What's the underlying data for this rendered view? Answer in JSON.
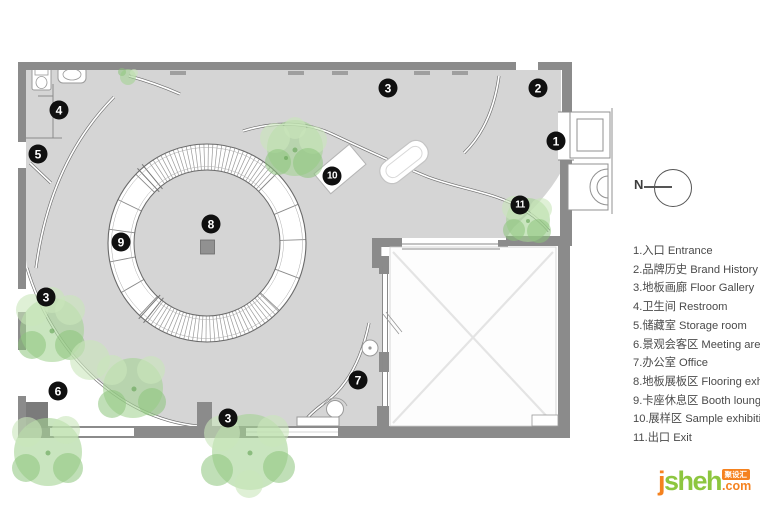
{
  "plan": {
    "markers": [
      {
        "n": "1",
        "x": 556,
        "y": 141
      },
      {
        "n": "2",
        "x": 538,
        "y": 88
      },
      {
        "n": "3",
        "x": 388,
        "y": 88
      },
      {
        "n": "3",
        "x": 46,
        "y": 297
      },
      {
        "n": "3",
        "x": 228,
        "y": 418
      },
      {
        "n": "4",
        "x": 59,
        "y": 110
      },
      {
        "n": "5",
        "x": 38,
        "y": 154
      },
      {
        "n": "6",
        "x": 58,
        "y": 391
      },
      {
        "n": "7",
        "x": 358,
        "y": 380
      },
      {
        "n": "8",
        "x": 211,
        "y": 224
      },
      {
        "n": "9",
        "x": 121,
        "y": 242
      },
      {
        "n": "10",
        "x": 332,
        "y": 176
      },
      {
        "n": "11",
        "x": 520,
        "y": 205
      }
    ],
    "colors": {
      "wall": "#8b8b8b",
      "floor": "#d5d5d5",
      "marker_bg": "#101010",
      "marker_text": "#ffffff",
      "tree_light": "#c9e6bb",
      "tree_mid": "#a5d394",
      "tree_dark": "#8cc47c"
    }
  },
  "compass": {
    "label": "N"
  },
  "legend": {
    "items": [
      {
        "num": "1",
        "zh": "入口",
        "en": "Entrance"
      },
      {
        "num": "2",
        "zh": "品牌历史",
        "en": "Brand History"
      },
      {
        "num": "3",
        "zh": "地板画廊",
        "en": "Floor Gallery"
      },
      {
        "num": "4",
        "zh": "卫生间",
        "en": "Restroom"
      },
      {
        "num": "5",
        "zh": "储藏室",
        "en": "Storage room"
      },
      {
        "num": "6",
        "zh": "景观会客区",
        "en": "Meeting area"
      },
      {
        "num": "7",
        "zh": "办公室",
        "en": "Office"
      },
      {
        "num": "8",
        "zh": "地板展板区",
        "en": "Flooring exhibition"
      },
      {
        "num": "9",
        "zh": "卡座休息区",
        "en": "Booth lounge"
      },
      {
        "num": "10",
        "zh": "展样区",
        "en": "Sample exhibition"
      },
      {
        "num": "11",
        "zh": "出口",
        "en": "Exit"
      }
    ]
  },
  "watermark": {
    "first_letter": "j",
    "rest": "sheh",
    "badge": "聚设汇",
    "tld": ".com",
    "colors": {
      "orange": "#f5821f",
      "green": "#8dc63f"
    }
  }
}
